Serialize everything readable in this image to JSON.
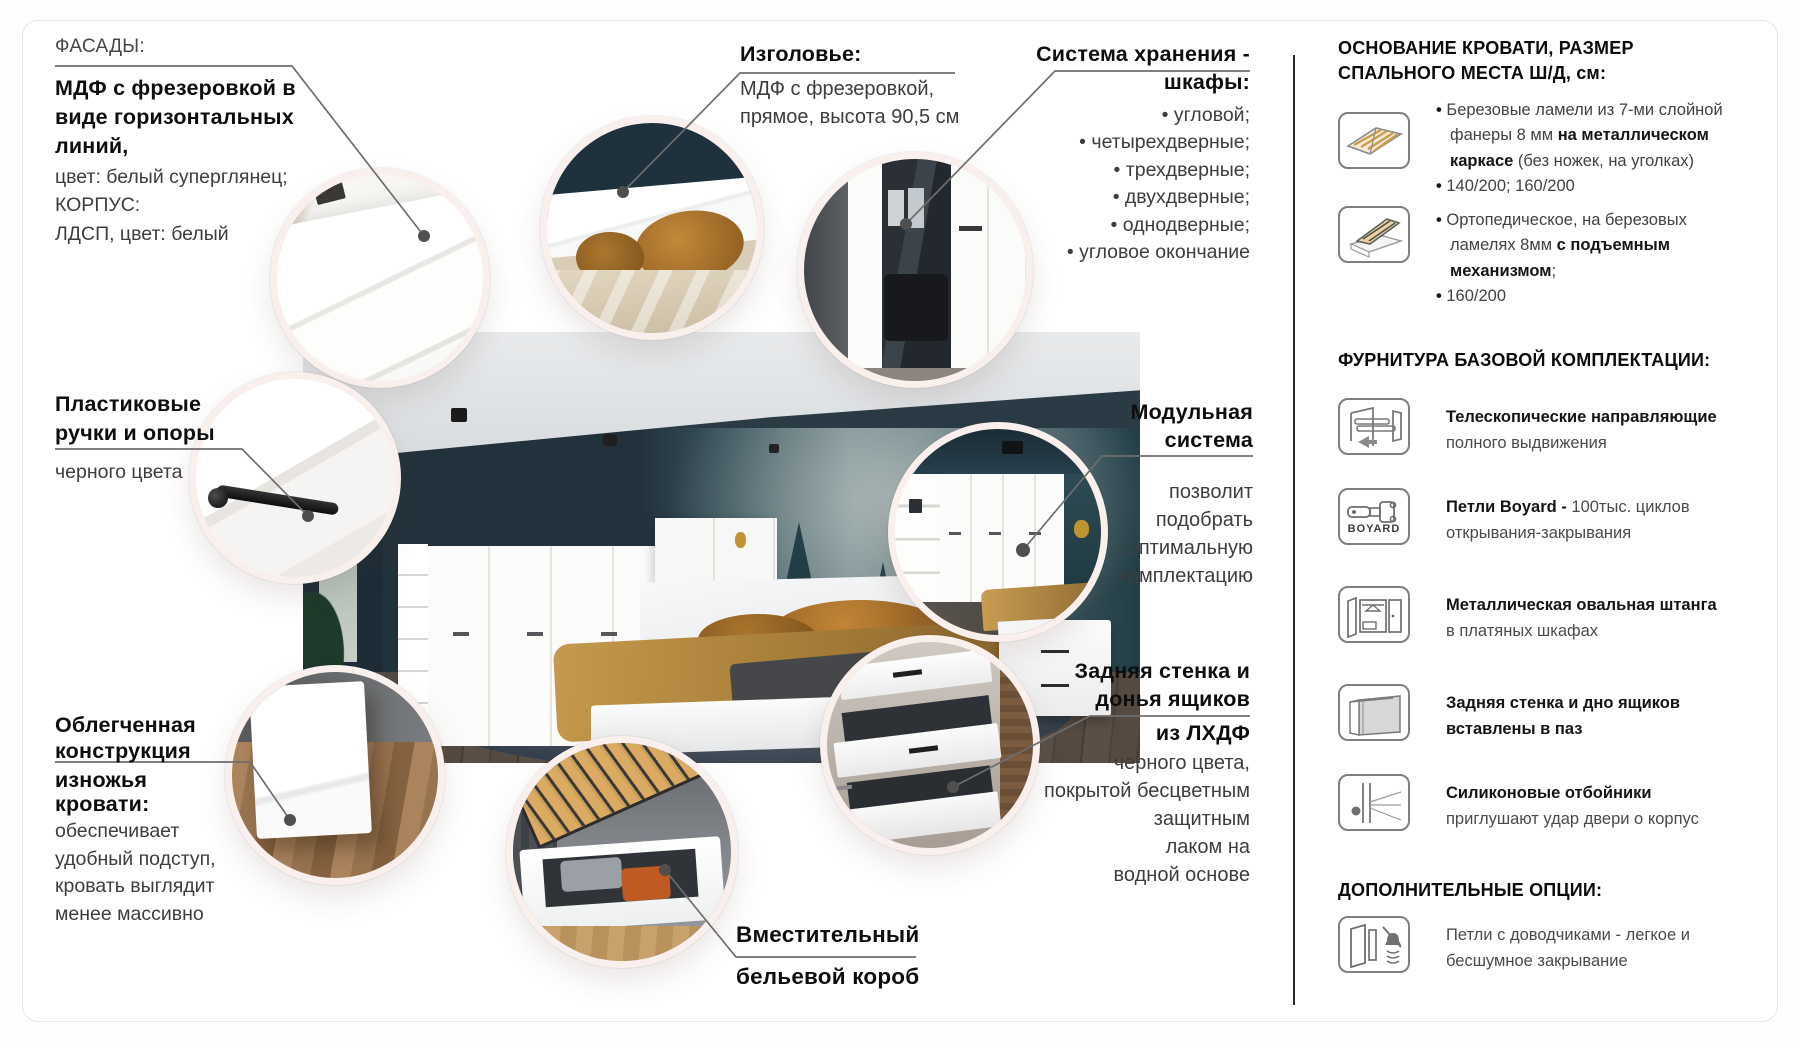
{
  "colors": {
    "circle_ring": "#f9efec",
    "callout_line": "#6e6e6e",
    "divider": "#2b2b2b",
    "text_bold": "#0d0d0d",
    "text_regular": "#3d3d3d",
    "wood_slats": "#d9a85f",
    "wall_teal": "#22323c",
    "blanket_mustard": "#c0924a"
  },
  "callouts": {
    "facades": {
      "label": "ФАСАДЫ:",
      "bold": [
        "МДФ с фрезеровкой в",
        "виде горизонтальных",
        "линий,"
      ],
      "regular": [
        "цвет: белый суперглянец;",
        "КОРПУС:",
        "ЛДСП, цвет: белый"
      ]
    },
    "headboard": {
      "title": "Изголовье:",
      "regular": [
        "МДФ с фрезеровкой,",
        "прямое, высота 90,5 см"
      ]
    },
    "storage": {
      "title": [
        "Система хранения -",
        "шкафы:"
      ],
      "bullets": [
        "• угловой;",
        "• четырехдверные;",
        "• трехдверные;",
        "• двухдверные;",
        "• однодверные;",
        "• угловое окончание"
      ]
    },
    "handles": {
      "bold": [
        "Пластиковые",
        "ручки и опоры"
      ],
      "regular": [
        "черного цвета"
      ]
    },
    "modular": {
      "title": [
        "Модульная",
        "система"
      ],
      "regular": [
        "позволит",
        "подобрать",
        "оптимальную",
        "комплектацию"
      ]
    },
    "footboard": {
      "bold1": [
        "Облегченная",
        "конструкция"
      ],
      "bold2": [
        "изножья",
        "кровати:"
      ],
      "regular": [
        "обеспечивает",
        "удобный подступ,",
        "кровать выглядит",
        "менее массивно"
      ]
    },
    "back_panels": {
      "bold1": [
        "Задняя стенка и",
        "донья ящиков"
      ],
      "bold2": "из ЛХДФ",
      "regular": [
        "черного цвета,",
        "покрытой бесцветным",
        "защитным",
        "лаком на",
        "водной основе"
      ]
    },
    "linen_box": {
      "bold": [
        "Вместительный",
        "бельевой короб"
      ]
    }
  },
  "sidebar": {
    "base_heading": [
      "ОСНОВАНИЕ КРОВАТИ, РАЗМЕР",
      "СПАЛЬНОГО МЕСТА Ш/Д, см:"
    ],
    "base_items": [
      {
        "icon": "slatted-base-icon",
        "lines": [
          [
            {
              "t": "• ",
              "b": 1
            },
            {
              "t": "Березовые ламели из 7-ми слойной",
              "b": 0
            }
          ],
          [
            {
              "t": "фанеры 8 мм ",
              "b": 0
            },
            {
              "t": "на металлическом",
              "b": 1
            }
          ],
          [
            {
              "t": "каркасе",
              "b": 1
            },
            {
              "t": " (без ножек, на уголках)",
              "b": 0
            }
          ],
          [
            {
              "t": "• ",
              "b": 1
            },
            {
              "t": "140/200; 160/200",
              "b": 0
            }
          ]
        ]
      },
      {
        "icon": "lift-bed-icon",
        "lines": [
          [
            {
              "t": "• ",
              "b": 1
            },
            {
              "t": "Ортопедическое, на березовых",
              "b": 0
            }
          ],
          [
            {
              "t": "ламелях 8мм ",
              "b": 0
            },
            {
              "t": "с подъемным",
              "b": 1
            }
          ],
          [
            {
              "t": "механизмом",
              "b": 1
            },
            {
              "t": ";",
              "b": 0
            }
          ],
          [
            {
              "t": "• ",
              "b": 1
            },
            {
              "t": "160/200",
              "b": 0
            }
          ]
        ]
      }
    ],
    "hardware_heading": "ФУРНИТУРА БАЗОВОЙ КОМПЛЕКТАЦИИ:",
    "hardware_items": [
      {
        "icon": "telescopic-slides-icon",
        "lines": [
          [
            {
              "t": "Телескопические направляющие",
              "b": 1
            }
          ],
          [
            {
              "t": "полного выдвижения",
              "b": 0
            }
          ]
        ]
      },
      {
        "icon": "boyard-hinge-icon",
        "icon_label": "BOYARD",
        "lines": [
          [
            {
              "t": "Петли Boyard - ",
              "b": 1
            },
            {
              "t": "100тыс. циклов",
              "b": 0
            }
          ],
          [
            {
              "t": "открывания-закрывания",
              "b": 0
            }
          ]
        ]
      },
      {
        "icon": "oval-rod-icon",
        "lines": [
          [
            {
              "t": "Металлическая овальная штанга",
              "b": 1
            }
          ],
          [
            {
              "t": "в платяных шкафах",
              "b": 0
            }
          ]
        ]
      },
      {
        "icon": "groove-panel-icon",
        "lines": [
          [
            {
              "t": "Задняя стенка и дно ящиков",
              "b": 1
            }
          ],
          [
            {
              "t": "вставлены в паз",
              "b": 1
            }
          ]
        ]
      },
      {
        "icon": "silicone-damper-icon",
        "lines": [
          [
            {
              "t": "Силиконовые отбойники",
              "b": 1
            }
          ],
          [
            {
              "t": "приглушают удар двери о корпус",
              "b": 0
            }
          ]
        ]
      }
    ],
    "options_heading": "ДОПОЛНИТЕЛЬНЫЕ ОПЦИИ:",
    "options_items": [
      {
        "icon": "soft-close-hinges-icon",
        "lines": [
          [
            {
              "t": "Петли с доводчиками - легкое и",
              "b": 0
            }
          ],
          [
            {
              "t": "бесшумное закрывание",
              "b": 0
            }
          ]
        ]
      }
    ]
  }
}
